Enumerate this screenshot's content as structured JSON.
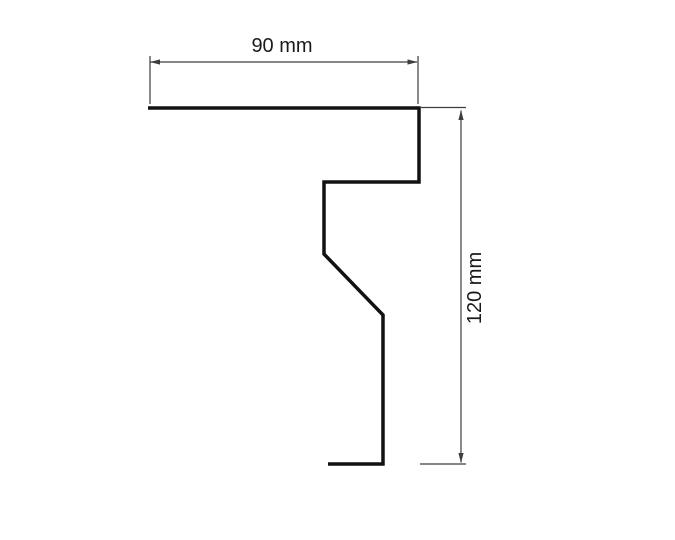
{
  "page": {
    "background_color": "#ffffff"
  },
  "diagram": {
    "type": "technical-profile-drawing",
    "profile": {
      "stroke_color": "#121212",
      "points": "148,108 419,108 419,182 324,182 324,254 383,315 383,464 328,464"
    },
    "dimension_style": {
      "line_color": "#3d3d3d",
      "label_color": "#1a1a1a"
    },
    "width_dimension": {
      "label": "90 mm",
      "value": 90,
      "unit": "mm"
    },
    "height_dimension": {
      "label": "120 mm",
      "value": 120,
      "unit": "mm"
    }
  }
}
